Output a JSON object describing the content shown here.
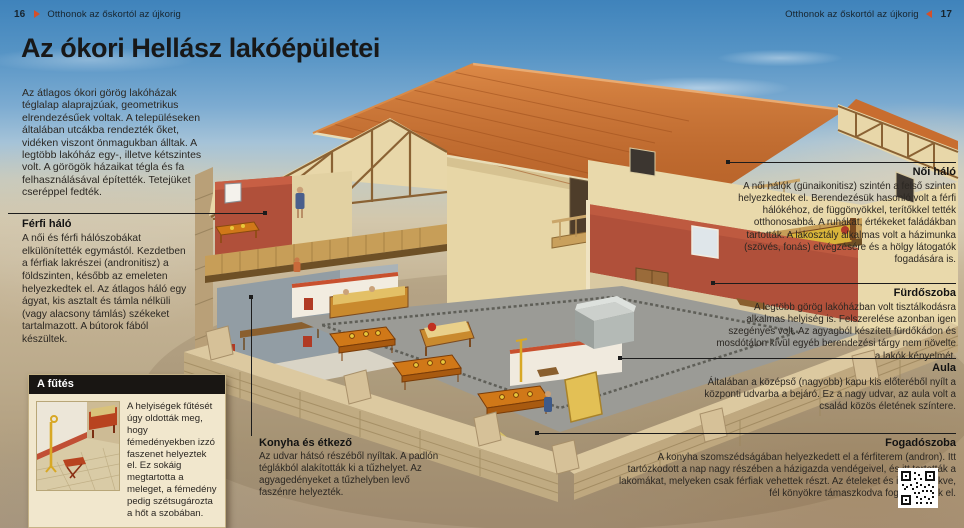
{
  "header": {
    "left": {
      "page_number": "16",
      "title": "Otthonok az őskortól az újkorig"
    },
    "right": {
      "page_number": "17",
      "title": "Otthonok az őskortól az újkorig"
    }
  },
  "title": "Az ókori Hellász lakóépületei",
  "intro": "Az átlagos ókori görög lakóházak téglalap alaprajzúak, geometrikus elrendezésűek voltak. A településeken általában utcákba rendezték őket, vidéken viszont önmagukban álltak. A legtöbb lakóház egy-, illetve kétszintes volt. A görögök házaikat tégla és fa felhasználásával építették. Tetejüket cseréppel fedték.",
  "callouts": {
    "ferfi_halo": {
      "title": "Férfi háló",
      "body": "A női és férfi hálószobákat elkülönítették egymástól. Kezdetben a férfiak lakrészei (andronitisz) a földszinten, később az emeleten helyezkedtek el. Az átlagos háló egy ágyat, kis asztalt és támla nélküli (vagy alacsony támlás) székeket tartalmazott. A bútorok fából készültek."
    },
    "konyha": {
      "title": "Konyha és étkező",
      "body": "Az udvar hátsó részéből nyíltak. A padlón téglákból alakították ki a tűzhelyet. Az agyagedényeket a tűzhelyben levő faszénre helyezték."
    },
    "noi_halo": {
      "title": "Női háló",
      "body": "A női hálók (günaikonitisz) szintén a felső szinten helyezkedtek el. Berendezésük hasonló volt a férfi hálókéhoz, de függönyökkel, terítőkkel tették otthonosabbá. A ruhákat, értékeket faládákban tartották. A lakosztály alkalmas volt a házimunka (szövés, fonás) elvégzésére és a hölgy látogatók fogadására is."
    },
    "furdoszoba": {
      "title": "Fürdőszoba",
      "body": "A legtöbb görög lakóházban volt tisztálkodásra alkalmas helyiség is. Felszerelése azonban igen szegényes volt. Az agyagból készített fürdőkádon és mosdótálon kívül egyéb berendezési tárgy nem növelte a lakók kényelmét."
    },
    "aula": {
      "title": "Aula",
      "body": "Általában a középső (nagyobb) kapu kis előteréből nyílt a központi udvarba a bejáró. Ez a nagy udvar, az aula volt a család közös életének színtere."
    },
    "fogadoszoba": {
      "title": "Fogadószoba",
      "body": "A konyha szomszédságában helyezkedett el a férfiterem (andron). Itt tartózkodott a nap nagy részében a házigazda vendégeivel, és itt tartották a lakomákat, melyeken csak férfiak vehettek részt. Az ételeket és italokat fekve, fél könyökre támaszkodva fogyasztották el."
    }
  },
  "infobox": {
    "title": "A fűtés",
    "body": "A helyiségek fűtését úgy oldották meg, hogy fémedényekben izzó faszenet helyeztek el. Ez sokáig megtartotta a meleget, a fémedény pedig szétsugározta a hőt a szobában."
  },
  "colors": {
    "accent": "#d4502a",
    "sky": "#3f83bb",
    "roof": "#c86d2f",
    "wall_cream": "#ecdcae",
    "wall_red": "#b0503a"
  }
}
